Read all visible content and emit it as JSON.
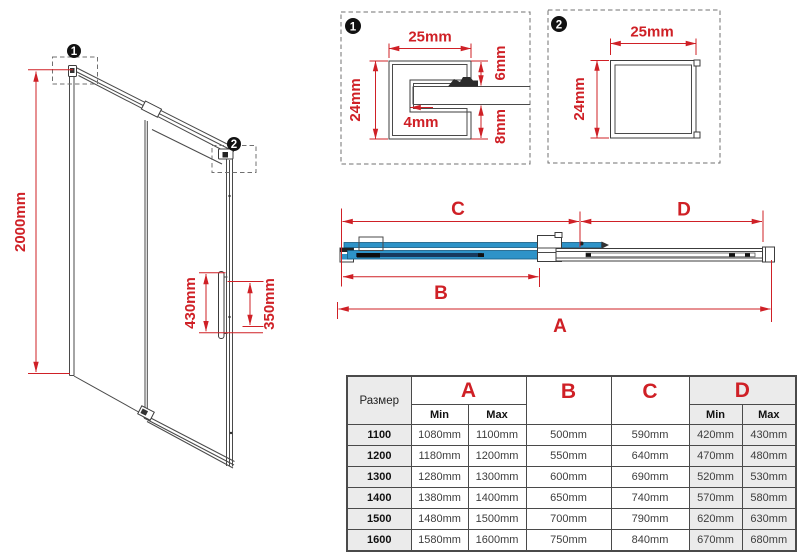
{
  "colors": {
    "dimension_red": "#cf2026",
    "glass_blue": "#2e93c8",
    "stripe_navy": "#173a5e",
    "table_shade": "#ebebeb"
  },
  "front_view": {
    "height_label": "2000mm",
    "handle_outer_label": "430mm",
    "handle_inner_label": "350mm",
    "callout1": "1",
    "callout2": "2"
  },
  "detail_one": {
    "callout": "1",
    "width_label": "25mm",
    "height_label": "24mm",
    "glass_label": "4mm",
    "top_gap_label": "6mm",
    "bottom_gap_label": "8mm"
  },
  "detail_two": {
    "callout": "2",
    "width_label": "25mm",
    "height_label": "24mm"
  },
  "plan_view": {
    "dim_a": "A",
    "dim_b": "B",
    "dim_c": "C",
    "dim_d": "D"
  },
  "table": {
    "size_header": "Размер",
    "col_a": "A",
    "col_b": "B",
    "col_c": "C",
    "col_d": "D",
    "min": "Min",
    "max": "Max",
    "rows": [
      {
        "size": "1100",
        "a_min": "1080mm",
        "a_max": "1100mm",
        "b": "500mm",
        "c": "590mm",
        "d_min": "420mm",
        "d_max": "430mm"
      },
      {
        "size": "1200",
        "a_min": "1180mm",
        "a_max": "1200mm",
        "b": "550mm",
        "c": "640mm",
        "d_min": "470mm",
        "d_max": "480mm"
      },
      {
        "size": "1300",
        "a_min": "1280mm",
        "a_max": "1300mm",
        "b": "600mm",
        "c": "690mm",
        "d_min": "520mm",
        "d_max": "530mm"
      },
      {
        "size": "1400",
        "a_min": "1380mm",
        "a_max": "1400mm",
        "b": "650mm",
        "c": "740mm",
        "d_min": "570mm",
        "d_max": "580mm"
      },
      {
        "size": "1500",
        "a_min": "1480mm",
        "a_max": "1500mm",
        "b": "700mm",
        "c": "790mm",
        "d_min": "620mm",
        "d_max": "630mm"
      },
      {
        "size": "1600",
        "a_min": "1580mm",
        "a_max": "1600mm",
        "b": "750mm",
        "c": "840mm",
        "d_min": "670mm",
        "d_max": "680mm"
      }
    ]
  }
}
